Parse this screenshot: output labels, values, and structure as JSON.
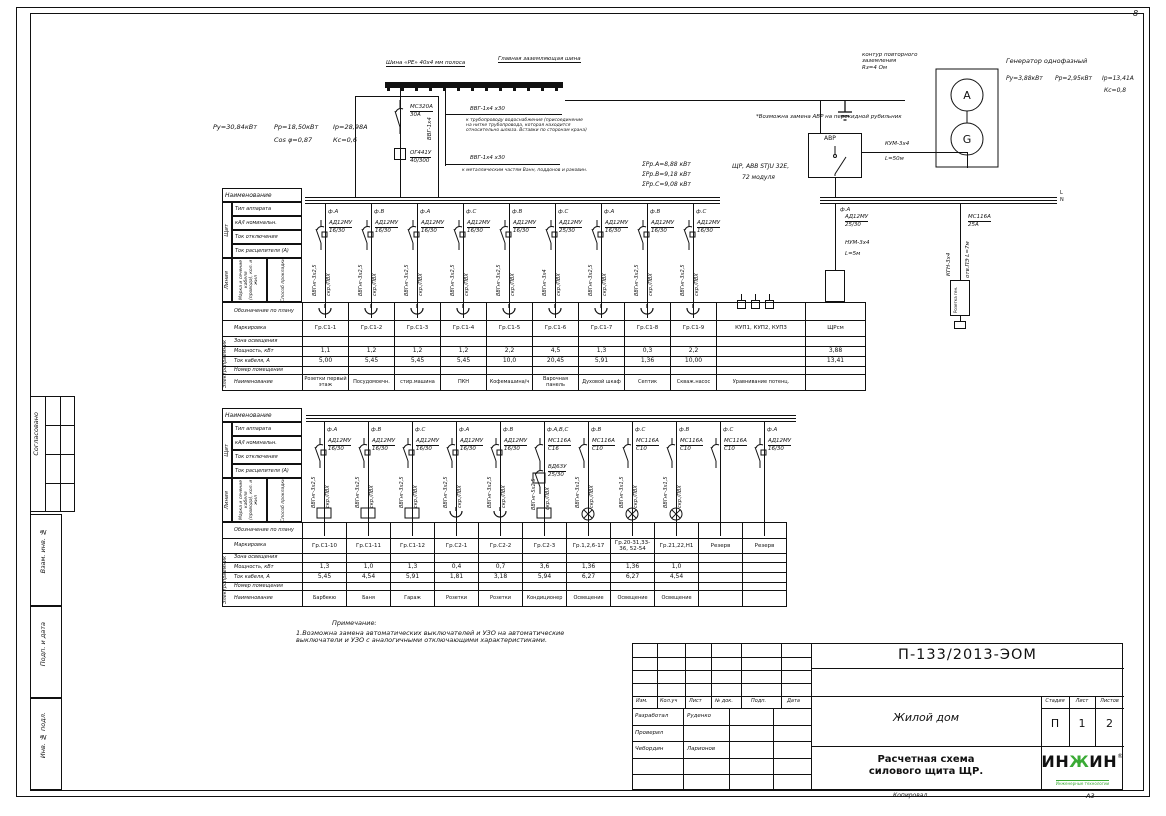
{
  "sheet": {
    "corner_mark": "8",
    "copied_label": "Копировал",
    "format_label": "А3",
    "side_labels": [
      "Согласовано",
      "Взам. инв. №",
      "Подп. и дата",
      "Инв. № подл."
    ]
  },
  "supply": {
    "pu": "Ру=30,84кВт",
    "pr": "Рр=18,50кВт",
    "ir": "Iр=28,98А",
    "cos": "Cos φ=0,87",
    "kc": "Кс=0,6",
    "breaker": "МС320А",
    "breaker_rating": "30А",
    "rcd": "ОГ441У",
    "rcd_rating": "40/300"
  },
  "gzsh": {
    "left_label": "Шина «PE» 40х4 мм полоса",
    "right_label": "Главная заземляющая шина",
    "riser": "ВВГ-1х4",
    "branch1_cable": "ВВГ-1х4 х30",
    "branch1_note": "к трубопроводу водоснабжения (присоединение на нитке трубопровода, которая находится относительно шлюза. Вставки по сторонам крана)",
    "branch2_cable": "ВВГ-1х4 х30",
    "branch2_note": "к металлическим частям Ванн, поддонов и раковин."
  },
  "generator": {
    "title": "Генератор однофазный",
    "pu": "Ру=3,88кВт",
    "pr": "Рр=2,95кВт",
    "ir": "Iр=13,41А",
    "kc": "Кс=0,8",
    "ground_note": "контур повторного\nзаземления\nRз=4 Ом",
    "top": "А",
    "bottom": "G"
  },
  "avr": {
    "label": "АВР",
    "note": "*Возможна замена АВР на перекидной рубильник",
    "gen_cable": "КУМ-3х4",
    "gen_len": "L=50м",
    "phase": "ф.А",
    "out_breaker": "АД12МУ",
    "out_rating": "25/30",
    "out_cable": "НУМ-3х4",
    "out_len": "L=5м",
    "sock_breaker": "МС116А",
    "sock_rating": "25А",
    "sock_cable": "КГН-3х4",
    "sock_route": "отв.ПЭ L=7м",
    "sock_label": "Розетка ген.",
    "bus_l": "L",
    "bus_n": "N"
  },
  "panel": {
    "name": "ЩР, АВВ STJU 32Е,",
    "modules": "72 модуля",
    "sum_a": "ΣРр.А=8,88 кВт",
    "sum_b": "ΣРр.В=9,18 кВт",
    "sum_c": "ΣРр.С=9,08 кВт"
  },
  "table_header": {
    "col_title": "Наименование",
    "group_board": "Щит",
    "board_rows": [
      "Тип аппарата",
      "кА/I номинальн.",
      "Ток отключения",
      "Ток расцепителя (А)"
    ],
    "group_line": "Линия",
    "line_rows": [
      "Марка и сечение кабеля (провода), кол. и жил",
      "Способ прокладки"
    ],
    "group_consumer": "Электроприемник",
    "consumer_rows": [
      "Обозначение по плану",
      "Маркировка",
      "Зона освещения",
      "Мощность, кВт",
      "Ток кабеля, А",
      "Номер помещения",
      "Наименование"
    ]
  },
  "circuits1": {
    "columns": [
      {
        "phase": "ф.А",
        "kind": "diff",
        "breaker": "АД12МУ",
        "rating": "16/30",
        "cable": "ВВГнг-3х2,5",
        "route": "скр./ПВХ",
        "mark": "Гр.С1-1",
        "power": "1,1",
        "current": "5,00",
        "name": "Розетки первый этаж",
        "symbol": "socket"
      },
      {
        "phase": "ф.В",
        "kind": "diff",
        "breaker": "АД12МУ",
        "rating": "16/30",
        "cable": "ВВГнг-3х2,5",
        "route": "скр./ПВХ",
        "mark": "Гр.С1-2",
        "power": "1,2",
        "current": "5,45",
        "name": "Посудомоечн.",
        "symbol": "socket"
      },
      {
        "phase": "ф.А",
        "kind": "diff",
        "breaker": "АД12МУ",
        "rating": "16/30",
        "cable": "ВВГнг-3х2,5",
        "route": "скр./ПВХ",
        "mark": "Гр.С1-3",
        "power": "1,2",
        "current": "5,45",
        "name": "стир.машина",
        "symbol": "socket"
      },
      {
        "phase": "ф.С",
        "kind": "diff",
        "breaker": "АД12МУ",
        "rating": "16/30",
        "cable": "ВВГнг-3х2,5",
        "route": "скр./ПВХ",
        "mark": "Гр.С1-4",
        "power": "1,2",
        "current": "5,45",
        "name": "ПКН",
        "symbol": "socket"
      },
      {
        "phase": "ф.В",
        "kind": "diff",
        "breaker": "АД12МУ",
        "rating": "16/30",
        "cable": "ВВГнг-3х2,5",
        "route": "скр./ПВХ",
        "mark": "Гр.С1-5",
        "power": "2,2",
        "current": "10,0",
        "name": "Кофемашина/ч",
        "symbol": "socket"
      },
      {
        "phase": "ф.С",
        "kind": "diff",
        "breaker": "АД12МУ",
        "rating": "25/30",
        "cable": "ВВГнг-3х4",
        "route": "скр./ПВХ",
        "mark": "Гр.С1-6",
        "power": "4,5",
        "current": "20,45",
        "name": "Варочная панель",
        "symbol": "socket"
      },
      {
        "phase": "ф.А",
        "kind": "diff",
        "breaker": "АД12МУ",
        "rating": "16/30",
        "cable": "ВВГнг-3х2,5",
        "route": "скр./ПВХ",
        "mark": "Гр.С1-7",
        "power": "1,3",
        "current": "5,91",
        "name": "Духовой шкаф",
        "symbol": "socket"
      },
      {
        "phase": "ф.В",
        "kind": "diff",
        "breaker": "АД12МУ",
        "rating": "16/30",
        "cable": "ВВГнг-3х2,5",
        "route": "скр./ПВХ",
        "mark": "Гр.С1-8",
        "power": "0,3",
        "current": "1,36",
        "name": "Септик",
        "symbol": "socket"
      },
      {
        "phase": "ф.С",
        "kind": "diff",
        "breaker": "АД12МУ",
        "rating": "16/30",
        "cable": "ВВГнг-3х2,5",
        "route": "скр./ПВХ",
        "mark": "Гр.С1-9",
        "power": "2,2",
        "current": "10,00",
        "name": "Скваж.насос",
        "symbol": "socket"
      }
    ],
    "extra": [
      {
        "mark": "КУП1, КУП2, КУП3",
        "power": "",
        "current": "",
        "name": "Уравнивание потенц."
      },
      {
        "mark": "ЩРсм",
        "power": "3,88",
        "current": "13,41",
        "name": ""
      }
    ]
  },
  "circuits2": {
    "columns": [
      {
        "phase": "ф.А",
        "kind": "diff",
        "breaker": "АД12МУ",
        "rating": "16/30",
        "cable": "ВВГнг-3х2,5",
        "route": "скр./ПВХ",
        "mark": "Гр.С1-10",
        "power": "1,3",
        "current": "5,45",
        "name": "Барбекю",
        "symbol": "box"
      },
      {
        "phase": "ф.В",
        "kind": "diff",
        "breaker": "АД12МУ",
        "rating": "16/30",
        "cable": "ВВГнг-3х2,5",
        "route": "скр./ПВХ",
        "mark": "Гр.С1-11",
        "power": "1,0",
        "current": "4,54",
        "name": "Баня",
        "symbol": "box"
      },
      {
        "phase": "ф.С",
        "kind": "diff",
        "breaker": "АД12МУ",
        "rating": "16/30",
        "cable": "ВВГнг-3х2,5",
        "route": "скр./ПВХ",
        "mark": "Гр.С1-12",
        "power": "1,3",
        "current": "5,91",
        "name": "Гараж",
        "symbol": "box"
      },
      {
        "phase": "ф.А",
        "kind": "diff",
        "breaker": "АД12МУ",
        "rating": "16/30",
        "cable": "ВВГнг-3х2,5",
        "route": "скр./ПВХ",
        "mark": "Гр.С2-1",
        "power": "0,4",
        "current": "1,81",
        "name": "Розетки",
        "symbol": "socket"
      },
      {
        "phase": "ф.В",
        "kind": "diff",
        "breaker": "АД12МУ",
        "rating": "16/30",
        "cable": "ВВГнг-3х2,5",
        "route": "скр./ПВХ",
        "mark": "Гр.С2-2",
        "power": "0,7",
        "current": "3,18",
        "name": "Розетки",
        "symbol": "socket"
      },
      {
        "phase": "ф.А,В,С",
        "kind": "auto",
        "breaker": "МС116А",
        "rating": "С16",
        "breaker2": "ВД63У",
        "rating2": "25/30",
        "cable": "ВВГнг-5х2,5",
        "route": "скр./ПВХ",
        "mark": "Гр.С2-3",
        "power": "3,6",
        "current": "5,94",
        "name": "Кондиционер",
        "symbol": "box"
      },
      {
        "phase": "ф.В",
        "kind": "auto",
        "breaker": "МС116А",
        "rating": "С10",
        "cable": "ВВГнг-3х1,5",
        "route": "скр./ПВХ",
        "mark": "Гр.1,2,6-17",
        "power": "1,36",
        "current": "6,27",
        "name": "Освещение",
        "symbol": "lamp"
      },
      {
        "phase": "ф.С",
        "kind": "auto",
        "breaker": "МС116А",
        "rating": "С10",
        "cable": "ВВГнг-3х1,5",
        "route": "скр./ПВХ",
        "mark": "Гр.20-31,33-36, 52-54",
        "power": "1,36",
        "current": "6,27",
        "name": "Освещение",
        "symbol": "lamp"
      },
      {
        "phase": "ф.В",
        "kind": "auto",
        "breaker": "МС116А",
        "rating": "С10",
        "cable": "ВВГнг-3х1,5",
        "route": "скр./ПВХ",
        "mark": "Гр.21,22,Н1",
        "power": "1,0",
        "current": "4,54",
        "name": "Освещение",
        "symbol": "lamp"
      },
      {
        "phase": "ф.С",
        "kind": "auto",
        "breaker": "МС116А",
        "rating": "С10",
        "cable": "",
        "route": "",
        "mark": "Резерв",
        "power": "",
        "current": "",
        "name": "",
        "symbol": "none"
      },
      {
        "phase": "ф.А",
        "kind": "diff",
        "breaker": "АД12МУ",
        "rating": "16/30",
        "cable": "",
        "route": "",
        "mark": "Резерв",
        "power": "",
        "current": "",
        "name": "",
        "symbol": "none"
      }
    ]
  },
  "notes": {
    "title": "Примечание:",
    "body": "1.Возможна замена автоматических выключателей и УЗО на автоматические\nвыключатели и УЗО с аналогичными отключающими характеристиками."
  },
  "titleblock": {
    "doc_number": "П-133/2013-ЭОМ",
    "rev_headers": [
      "Изм.",
      "Кол.уч",
      "Лист",
      "№ док.",
      "Подп.",
      "Дата"
    ],
    "sig_rows": [
      {
        "role": "Разработал",
        "name": "Руденко"
      },
      {
        "role": "Проверил",
        "name": ""
      },
      {
        "role": "Чебордин",
        "name": "Ларионов"
      }
    ],
    "object_name": "Жилой дом",
    "stage_label": "Стадия",
    "sheet_label": "Лист",
    "sheets_label": "Листов",
    "stage": "П",
    "sheet": "1",
    "sheets": "2",
    "drawing_title": "Расчетная схема\nсилового щита ЩР.",
    "logo_p1": "ИН",
    "logo_p2": "Ж",
    "logo_p3": "ИН",
    "logo_reg": "®",
    "logo_sub": "Инженерные технологии",
    "logo_green": "#3aaa35"
  }
}
